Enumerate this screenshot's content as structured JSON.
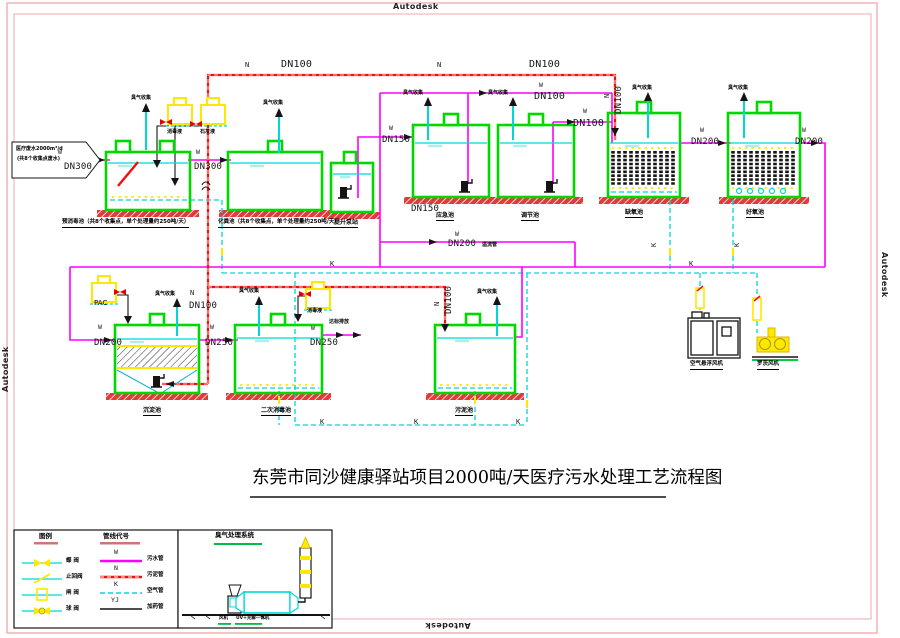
{
  "watermark": "Autodesk",
  "title": "东莞市同沙健康驿站项目2000吨/天医疗污水处理工艺流程图",
  "inflow": {
    "line1": "医疗废水2000m³/d",
    "line2": "(共8个收集点废水)"
  },
  "odor": "臭气收集",
  "codes": {
    "w": "W",
    "n": "N",
    "k": "K",
    "yj": "YJ"
  },
  "dn": {
    "d100": "DN100",
    "d150": "DN150",
    "d200": "DN200",
    "d250": "DN250",
    "d300": "DN300"
  },
  "notes": {
    "overflow": "溢流管",
    "discharge": "达标排放",
    "pac": "PAC",
    "disinfectant": "消毒液",
    "lime": "石灰液",
    "break": "≈"
  },
  "tanks": {
    "pre": "预消毒池（共8个收集点，单个处理量约250吨/天）",
    "septic": "化粪池（共8个收集点，单个处理量约250吨/天）",
    "lift": "提升泵站",
    "emergency": "应急池",
    "regulating": "调节池",
    "anoxic": "缺氧池",
    "aerobic": "好氧池",
    "sediment": "沉淀池",
    "secondary": "二次消毒池",
    "sludge": "污泥池"
  },
  "equipment": {
    "blower_air": "空气悬浮风机",
    "blower_roots": "罗茨风机"
  },
  "legend": {
    "symbols_title": "图例",
    "codes_title": "管线代号",
    "valves": [
      "蝶 阀",
      "止回阀",
      "闸 阀",
      "球 阀"
    ],
    "lines": [
      {
        "code": "W",
        "name": "污水管"
      },
      {
        "code": "N",
        "name": "污泥管"
      },
      {
        "code": "K",
        "name": "空气管"
      },
      {
        "code": "YJ",
        "name": "加药管"
      }
    ],
    "odor_title": "臭气处理系统",
    "fan": "风机",
    "uv": "UV+光解一体机"
  },
  "colors": {
    "tank": "#00d800",
    "water": "#00d8d8",
    "sewage_w": "#ff00ff",
    "sludge_n": "#f01010",
    "air_k": "#00d8d8",
    "dosing_yj": "#111111",
    "frame": "#f0a8a8",
    "valve": "#ffe800"
  }
}
